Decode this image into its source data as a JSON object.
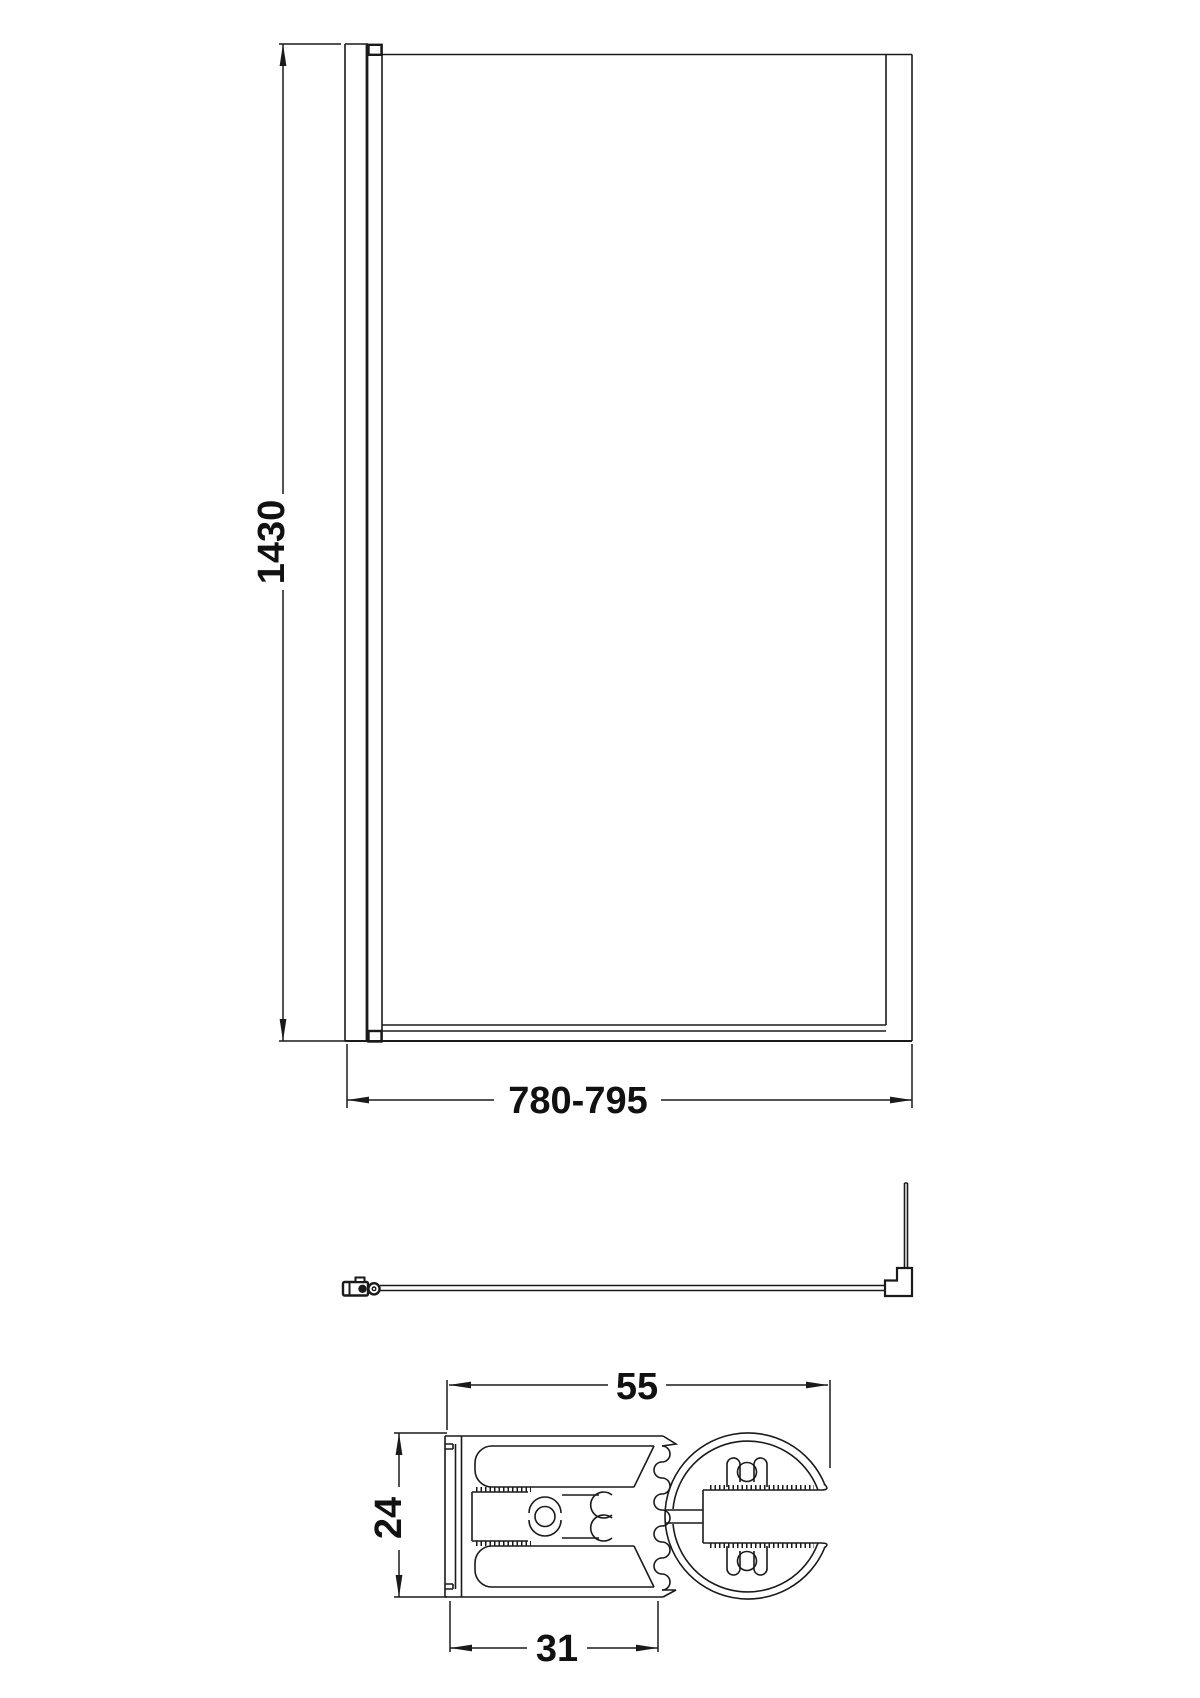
{
  "page": {
    "background": "#ffffff",
    "line_color": "#1a1a1a",
    "text_color": "#111111"
  },
  "front_view": {
    "height_label": "1430",
    "width_label": "780-795"
  },
  "cross_section": {
    "width_label": "55",
    "height_label": "24",
    "base_width_label": "31"
  }
}
